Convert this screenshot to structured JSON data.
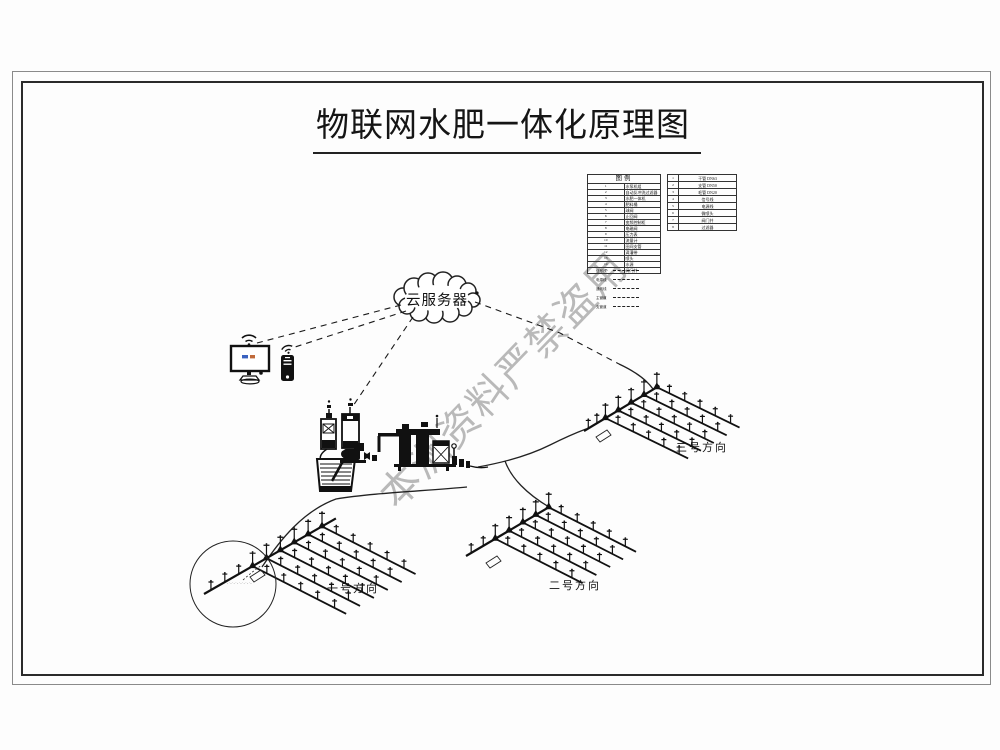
{
  "title": "物联网水肥一体化原理图",
  "watermark": "本洲资料严禁盗用",
  "cloud": {
    "label": "云服务器"
  },
  "legend": {
    "header": "图例",
    "left_rows": [
      {
        "num": "1",
        "name": "水泵机组"
      },
      {
        "num": "2",
        "name": "自动反冲洗过滤器"
      },
      {
        "num": "3",
        "name": "水肥一体机"
      },
      {
        "num": "4",
        "name": "肥料桶"
      },
      {
        "num": "5",
        "name": "球阀"
      },
      {
        "num": "6",
        "name": "止回阀"
      },
      {
        "num": "7",
        "name": "变频控制柜"
      },
      {
        "num": "8",
        "name": "电磁阀"
      },
      {
        "num": "9",
        "name": "压力表"
      },
      {
        "num": "10",
        "name": "流量计"
      },
      {
        "num": "11",
        "name": "田间支管"
      },
      {
        "num": "12",
        "name": "滴灌带"
      },
      {
        "num": "13",
        "name": "喷头"
      },
      {
        "num": "14",
        "name": "水源"
      },
      {
        "num": "15",
        "name": "阀门井"
      }
    ],
    "right_rows": [
      {
        "num": "1",
        "name": "干管 DN63"
      },
      {
        "num": "2",
        "name": "支管 DN50"
      },
      {
        "num": "3",
        "name": "毛管 DN20"
      },
      {
        "num": "4",
        "name": "信号线"
      },
      {
        "num": "5",
        "name": "电源线"
      },
      {
        "num": "6",
        "name": "微喷头"
      },
      {
        "num": "7",
        "name": "阀门井"
      },
      {
        "num": "8",
        "name": "过滤器"
      }
    ],
    "line_rows": [
      {
        "label": "信号线"
      },
      {
        "label": "电源线"
      },
      {
        "label": "通讯线"
      },
      {
        "label": "主管道"
      },
      {
        "label": "支管道"
      }
    ]
  },
  "fields": [
    {
      "label": "一号方向"
    },
    {
      "label": "二号方向"
    },
    {
      "label": "三号方向"
    }
  ],
  "detail_note": "-·-·-·-·-·-·-·-",
  "icons": {
    "wifi": "wifi-icon",
    "monitor": "monitor-icon",
    "smartphone": "smartphone-icon",
    "cloud": "cloud-shape"
  },
  "colors": {
    "line": "#1a1a1a",
    "watermark": "#b0b0b0",
    "frame": "#2b2b2b"
  }
}
